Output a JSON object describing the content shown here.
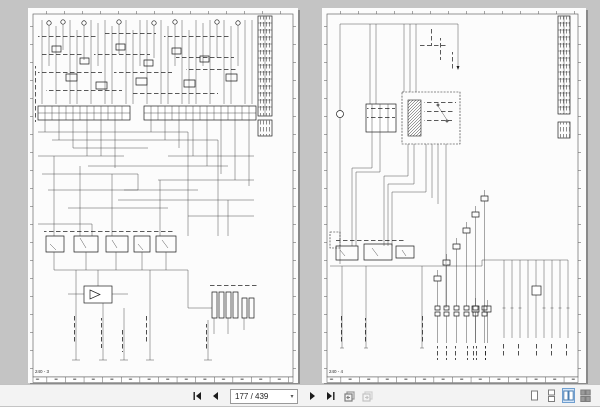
{
  "viewer": {
    "pages": {
      "left": {
        "page_label": "240 - 3"
      },
      "right": {
        "page_label": "240 - 4"
      }
    },
    "toolbar": {
      "page_indicator": "177 / 439",
      "dropdown_glyph": "▾",
      "icons": {
        "first": "first-page-icon",
        "previous": "previous-page-icon",
        "next": "next-page-icon",
        "last": "last-page-icon",
        "previous_view": "previous-view-icon",
        "next_view": "next-view-icon"
      },
      "view_modes": [
        "Single Page",
        "Continuous",
        "Facing",
        "Facing Continuous"
      ],
      "selected_view_mode": "Facing"
    },
    "colors": {
      "canvas": "#c4c4c4",
      "toolbar_bg": "#f3f3f3",
      "selection_accent": "#6f9fd0",
      "page": "#fcfcfc"
    }
  }
}
